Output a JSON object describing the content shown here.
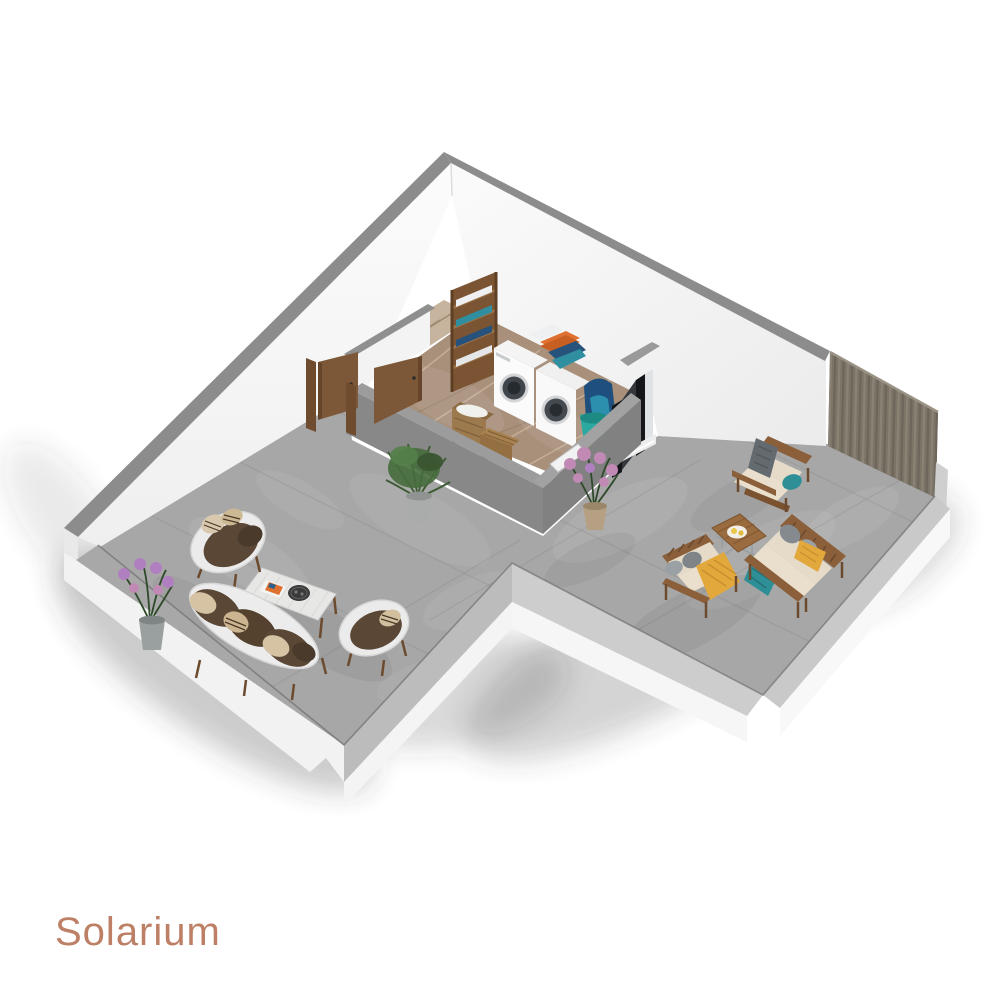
{
  "page": {
    "background": "#ffffff"
  },
  "title": {
    "label": "Solarium",
    "color": "#bd8066",
    "font_size": 40
  },
  "scene": {
    "type": "isometric-3d-floorplan-render",
    "rooms": [
      {
        "name": "solarium-terrace",
        "floor": "gray concrete"
      },
      {
        "name": "laundry-room",
        "floor": "brown marble"
      }
    ],
    "objects": [
      "staircase",
      "wooden-doors",
      "storage-shelf-with-towels",
      "washing-machine",
      "dryer",
      "folded-towels",
      "wicker-laundry-baskets",
      "cleaning-bucket",
      "backpack",
      "sliding-glass-door",
      "privacy-louver-screen",
      "white-lounge-armchair",
      "white-lounge-sofa",
      "rattan-coffee-table",
      "magazine",
      "round-serving-tray",
      "wood-outdoor-armchair",
      "wood-outdoor-loveseat",
      "wood-outdoor-sofa",
      "square-wood-coffee-table",
      "potted-green-plant",
      "purple-flower-plant"
    ],
    "colors": {
      "terrace_floor": "#a7a7a7",
      "laundry_floor": "#a8907b",
      "wall_white": "#f7f7f7",
      "wall_cap": "#8c8c8c",
      "half_wall": "#888888",
      "half_wall_cap": "#9c9c9c",
      "parapet_cap": "#c9c9c9",
      "louver_screen": "#7c7467",
      "wood": "#8a5f3a",
      "door_wood": "#7d5838",
      "stair_beige": "#c7b49e",
      "cushion_brown": "#5a4736",
      "cushion_cream": "#e6dbc8",
      "pillow_beige": "#d6c3a4",
      "accent_teal": "#2e8f96",
      "accent_yellow": "#e2a83c",
      "towel_orange": "#e0702f",
      "towel_navy": "#27527c",
      "glass_dark": "#34383d",
      "plant_green": "#3e5c35",
      "flower_purple": "#b07fc0",
      "flower_pink": "#c08ab4"
    }
  }
}
